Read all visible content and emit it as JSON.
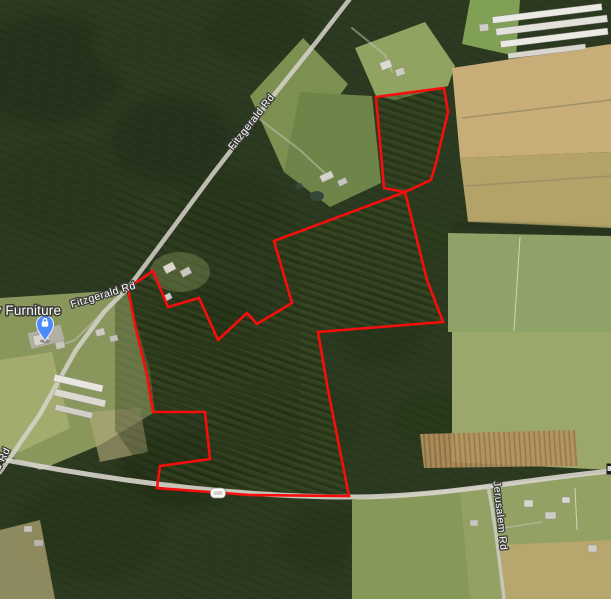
{
  "map": {
    "view_type": "satellite",
    "labels": {
      "road_fitzgerald_top": "Fitzgerald Rd",
      "road_fitzgerald_left": "Fitzgerald Rd",
      "road_fitzgerald_edge_partial": "rald Rd",
      "road_jerusalem": "Jerusalem Rd",
      "poi_furniture": "ay Furniture"
    },
    "poi": {
      "pin_icon": "shopping-bag-pin",
      "pin_color": "#4b8af8"
    },
    "route_shield": {
      "label": ""
    },
    "colors": {
      "boundary": "#f80d0d",
      "road": "#d8d5cc"
    }
  },
  "boundary": {
    "color": "#f80d0d",
    "stroke_width": 2.6,
    "parcels": [
      {
        "name": "north-parcel",
        "points": [
          [
            376,
            97
          ],
          [
            444,
            88
          ],
          [
            448,
            112
          ],
          [
            436,
            163
          ],
          [
            431,
            180
          ],
          [
            405,
            192
          ],
          [
            384,
            188
          ]
        ]
      },
      {
        "name": "main-parcel",
        "points": [
          [
            405,
            192
          ],
          [
            427,
            280
          ],
          [
            443,
            322
          ],
          [
            318,
            332
          ],
          [
            328,
            390
          ],
          [
            349,
            496
          ],
          [
            250,
            495
          ],
          [
            157,
            488
          ],
          [
            160,
            466
          ],
          [
            210,
            459
          ],
          [
            205,
            412
          ],
          [
            153,
            412
          ],
          [
            147,
            375
          ],
          [
            135,
            325
          ],
          [
            128,
            288
          ],
          [
            153,
            271
          ],
          [
            168,
            307
          ],
          [
            199,
            298
          ],
          [
            218,
            340
          ],
          [
            247,
            313
          ],
          [
            257,
            324
          ],
          [
            292,
            303
          ],
          [
            274,
            241
          ]
        ]
      }
    ]
  }
}
